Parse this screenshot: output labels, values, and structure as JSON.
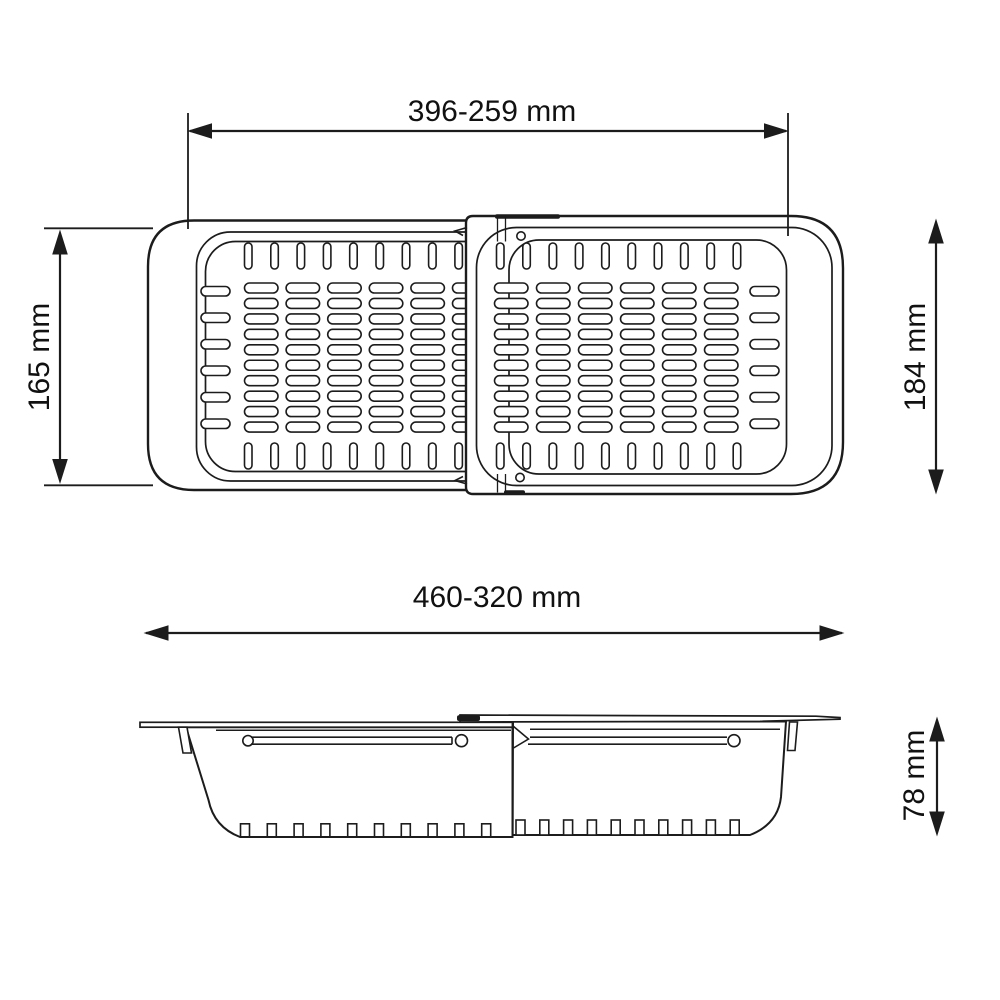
{
  "colors": {
    "background": "#ffffff",
    "line": "#1c1c1c",
    "text": "#111111"
  },
  "dimensions": {
    "top_width": {
      "label": "396-259 mm"
    },
    "left_height": {
      "label": "165 mm"
    },
    "right_height": {
      "label": "184 mm"
    },
    "overall_width": {
      "label": "460-320 mm"
    },
    "side_height": {
      "label": "78 mm"
    }
  }
}
